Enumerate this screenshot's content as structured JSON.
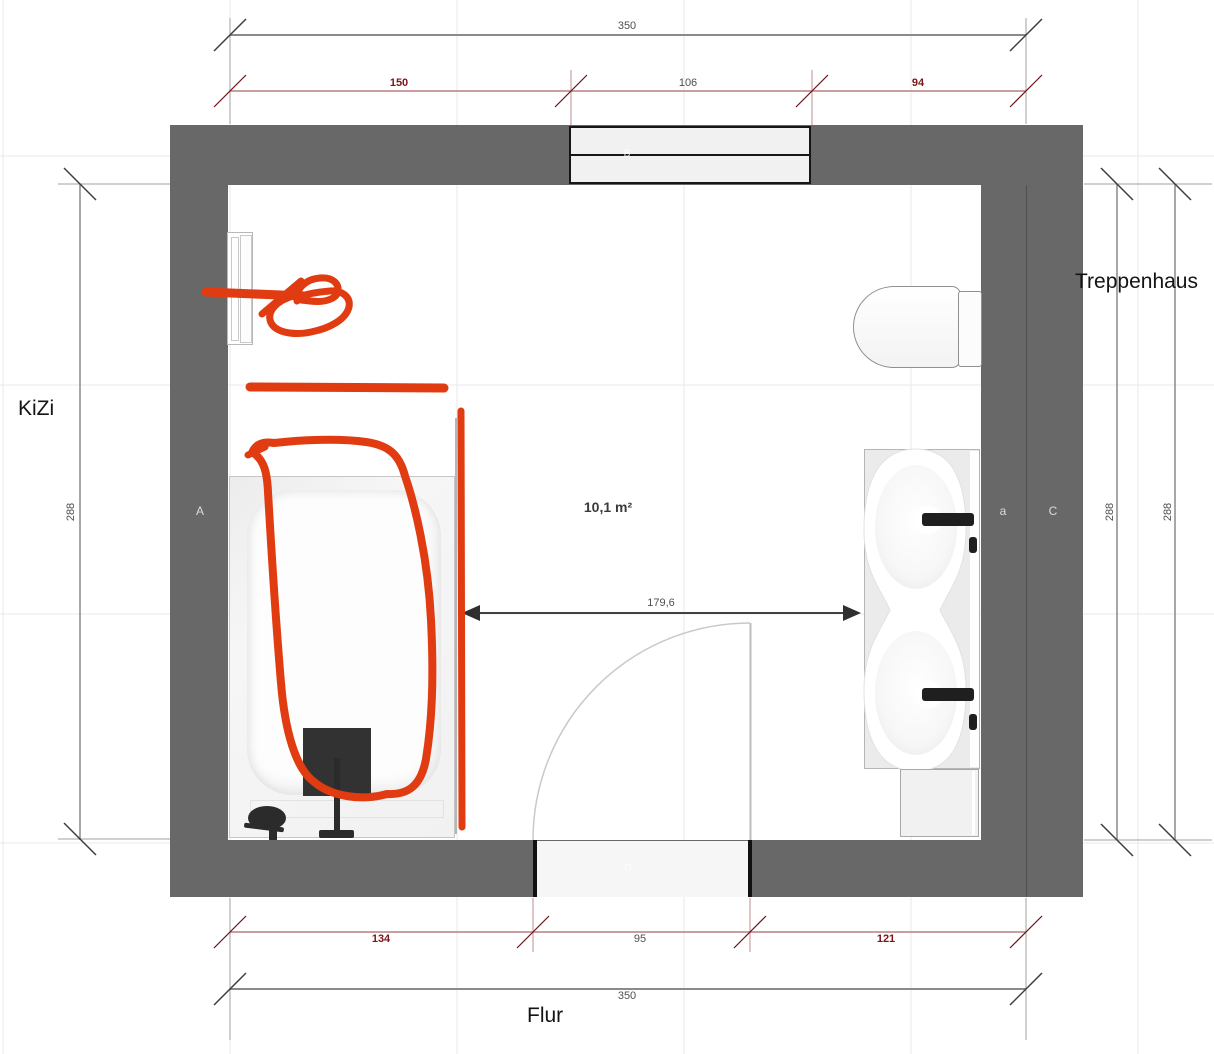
{
  "plan": {
    "area_label": "10,1 m²",
    "rooms": {
      "left": "KiZi",
      "right": "Treppenhaus",
      "bottom": "Flur"
    },
    "wall_letters": {
      "left": "A",
      "right_inner": "a",
      "right_outer": "C"
    },
    "openings": {
      "window": "B",
      "door": "D"
    },
    "dims": {
      "top_total": "350",
      "top_left": "150",
      "top_mid": "106",
      "top_right": "94",
      "left_side": "288",
      "right_inner": "288",
      "right_outer": "288",
      "bottom_left": "134",
      "bottom_mid": "95",
      "bottom_right": "121",
      "bottom_total": "350",
      "interior_width": "179,6"
    },
    "colors": {
      "wall": "#686868",
      "marker_red": "#e13b12",
      "dim_red_text": "#7d1418",
      "dim_red_line": "#b87f7f",
      "dim_gray_text": "#4f4f4f",
      "dim_gray_line": "#919191",
      "grid": "#e8e8e8"
    }
  }
}
